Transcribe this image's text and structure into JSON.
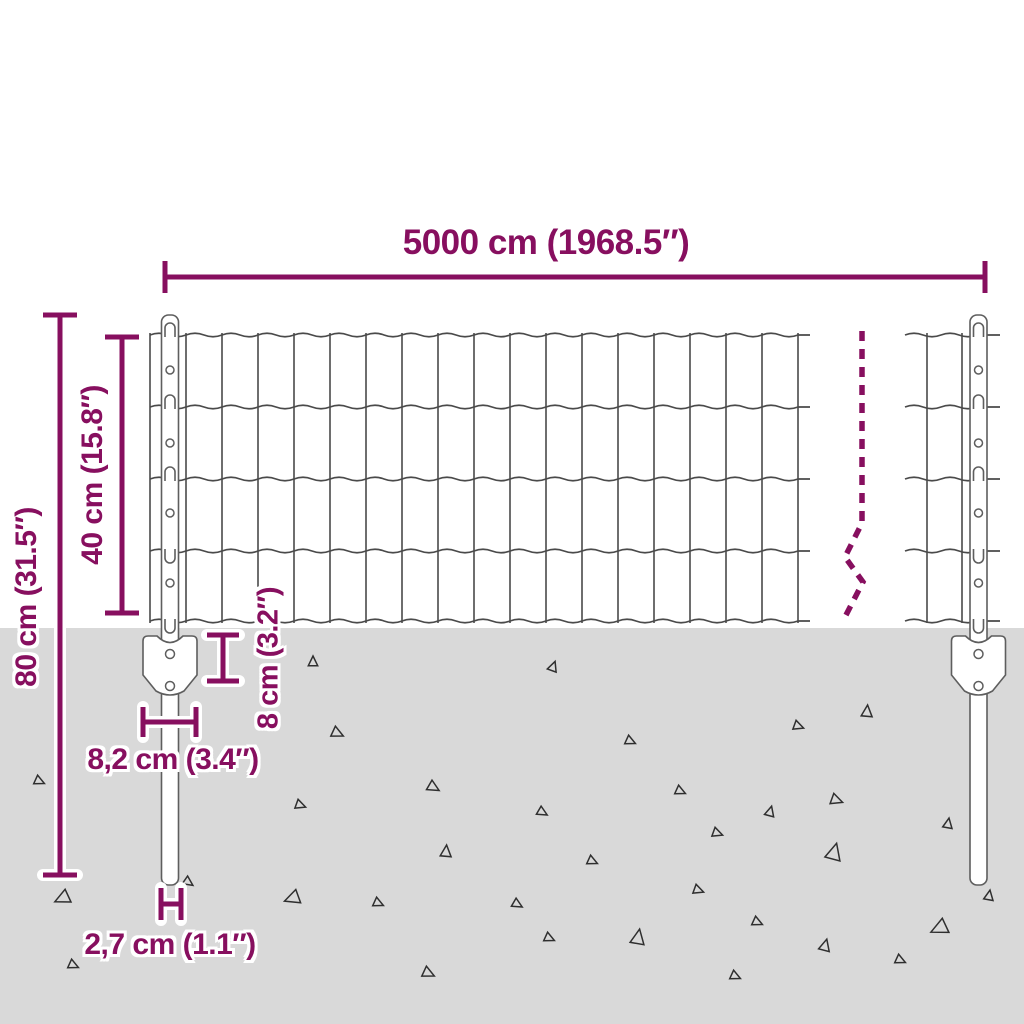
{
  "diagram": {
    "dimensions": {
      "width": {
        "label": "5000 cm (1968.5″)"
      },
      "total_height": {
        "label": "80 cm (31.5″)"
      },
      "panel_height": {
        "label": "40 cm (15.8″)"
      },
      "anchor_depth": {
        "label": "8 cm (3.2″)"
      },
      "anchor_width": {
        "label": "8,2 cm (3.4″)"
      },
      "post_diameter": {
        "label": "2,7 cm (1.1″)"
      }
    },
    "colors": {
      "accent": "#870f5f",
      "ground": "#d9d9d9",
      "wire": "#4a4a4a",
      "steel_outline": "#5e5e5e",
      "gravel": "#2f2f2f",
      "background": "#ffffff"
    },
    "gravel": [
      {
        "x": 313,
        "y": 662,
        "s": 6,
        "r": 0
      },
      {
        "x": 553,
        "y": 667,
        "s": 6,
        "r": 20
      },
      {
        "x": 867,
        "y": 712,
        "s": 7,
        "r": 5
      },
      {
        "x": 337,
        "y": 733,
        "s": 7,
        "r": 115
      },
      {
        "x": 630,
        "y": 741,
        "s": 6,
        "r": 115
      },
      {
        "x": 798,
        "y": 726,
        "s": 6,
        "r": 110
      },
      {
        "x": 39,
        "y": 781,
        "s": 6,
        "r": 115
      },
      {
        "x": 433,
        "y": 787,
        "s": 7,
        "r": 120
      },
      {
        "x": 300,
        "y": 805,
        "s": 6,
        "r": 110
      },
      {
        "x": 542,
        "y": 812,
        "s": 6,
        "r": 120
      },
      {
        "x": 680,
        "y": 791,
        "s": 6,
        "r": 115
      },
      {
        "x": 836,
        "y": 800,
        "s": 7,
        "r": 110
      },
      {
        "x": 770,
        "y": 812,
        "s": 6,
        "r": 15
      },
      {
        "x": 948,
        "y": 824,
        "s": 6,
        "r": 10
      },
      {
        "x": 446,
        "y": 852,
        "s": 7,
        "r": 5
      },
      {
        "x": 592,
        "y": 861,
        "s": 6,
        "r": 115
      },
      {
        "x": 717,
        "y": 833,
        "s": 6,
        "r": 110
      },
      {
        "x": 834,
        "y": 853,
        "s": 10,
        "r": 15
      },
      {
        "x": 989,
        "y": 896,
        "s": 6,
        "r": 10
      },
      {
        "x": 63,
        "y": 898,
        "s": 9,
        "r": 245
      },
      {
        "x": 188,
        "y": 882,
        "s": 6,
        "r": 125
      },
      {
        "x": 293,
        "y": 898,
        "s": 9,
        "r": 250
      },
      {
        "x": 378,
        "y": 903,
        "s": 6,
        "r": 115
      },
      {
        "x": 517,
        "y": 904,
        "s": 6,
        "r": 120
      },
      {
        "x": 698,
        "y": 890,
        "s": 6,
        "r": 110
      },
      {
        "x": 757,
        "y": 922,
        "s": 6,
        "r": 115
      },
      {
        "x": 549,
        "y": 938,
        "s": 6,
        "r": 115
      },
      {
        "x": 638,
        "y": 938,
        "s": 9,
        "r": 10
      },
      {
        "x": 940,
        "y": 928,
        "s": 10,
        "r": 245
      },
      {
        "x": 825,
        "y": 946,
        "s": 7,
        "r": 15
      },
      {
        "x": 900,
        "y": 960,
        "s": 6,
        "r": 115
      },
      {
        "x": 428,
        "y": 973,
        "s": 7,
        "r": 115
      },
      {
        "x": 735,
        "y": 976,
        "s": 6,
        "r": 115
      },
      {
        "x": 73,
        "y": 965,
        "s": 6,
        "r": 115
      }
    ]
  }
}
